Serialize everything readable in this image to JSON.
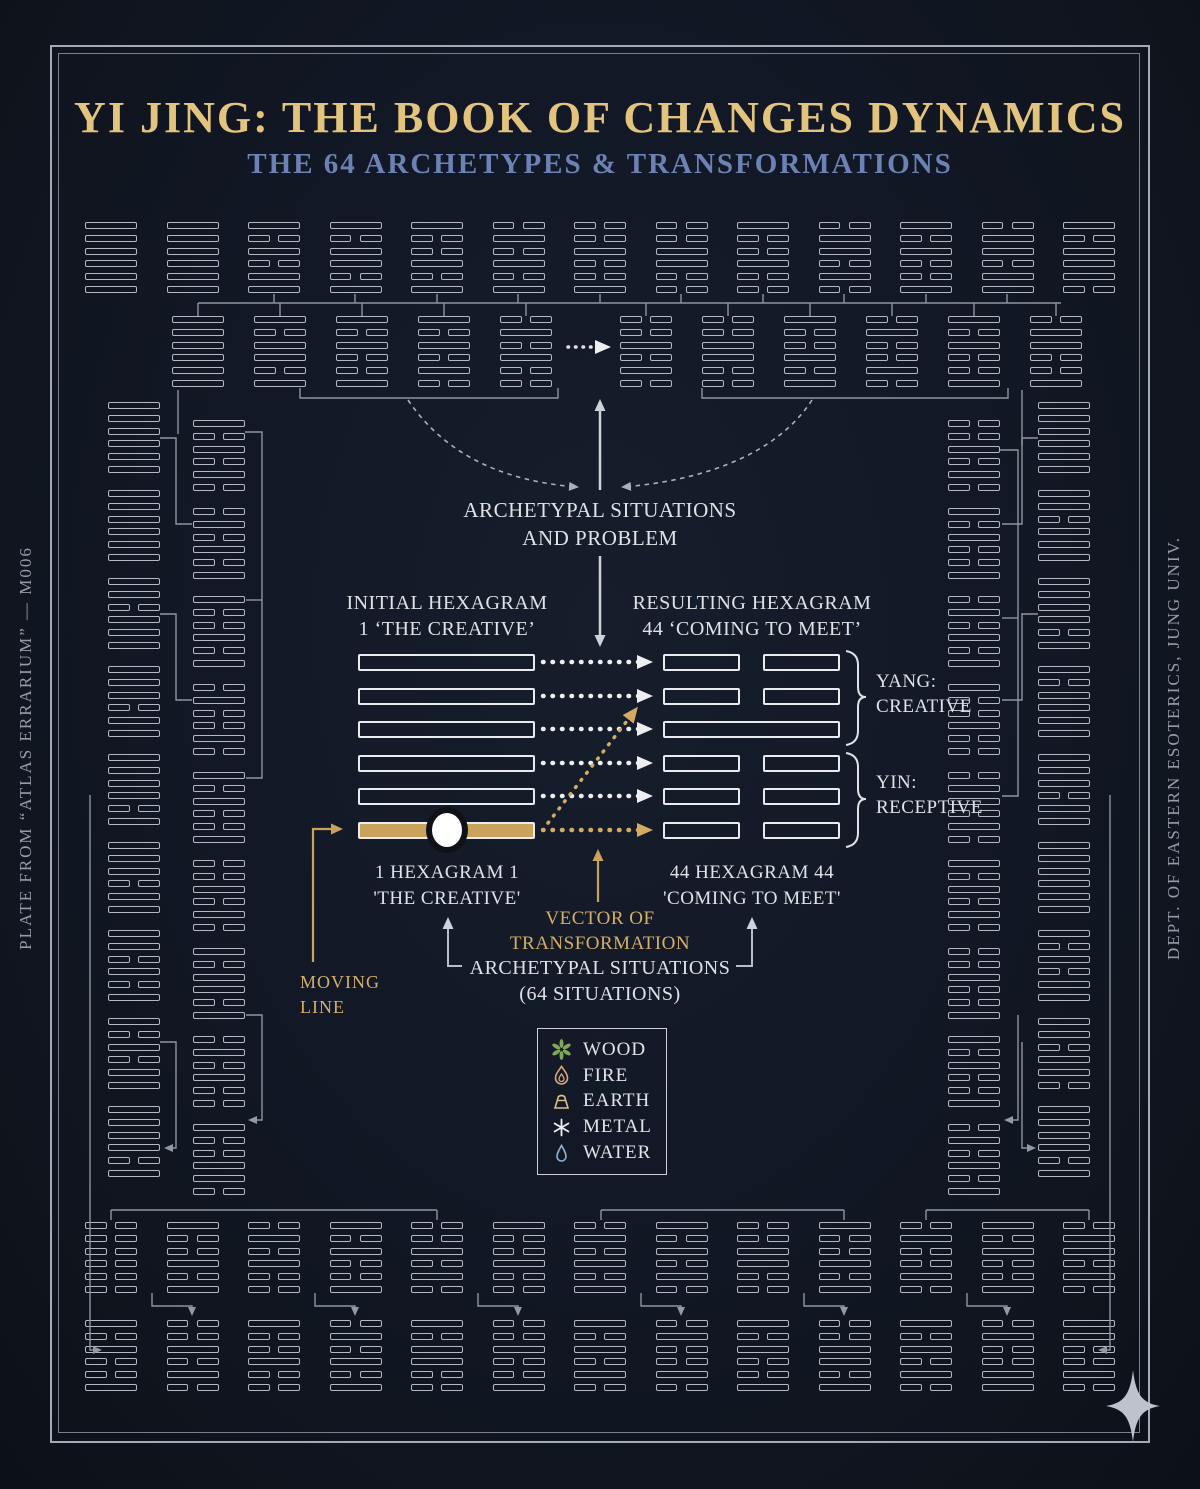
{
  "title": "YI JING: THE BOOK OF CHANGES DYNAMICS",
  "subtitle": "THE 64 ARCHETYPES & TRANSFORMATIONS",
  "side_left": "PLATE FROM “ATLAS ERRARIUM” — M006",
  "side_right": "DEPT. OF EASTERN ESOTERICS, JUNG UNIV.",
  "colors": {
    "background": "#121826",
    "title_gold": "#e3c47e",
    "subtitle_blue": "#6d82b4",
    "gold_accent": "#c9a35c",
    "gold_text": "#d4af69",
    "hexagram_line": "#c2c8d1",
    "text_white": "#dfe2e7"
  },
  "center": {
    "archetypal_top_line1": "ARCHETYPAL SITUATIONS",
    "archetypal_top_line2": "AND PROBLEM",
    "initial_label_line1": "INITIAL HEXAGRAM",
    "initial_label_line2": "1 ‘THE CREATIVE’",
    "resulting_label_line1": "RESULTING HEXAGRAM",
    "resulting_label_line2": "44 ‘COMING TO MEET’",
    "yang_label_line1": "YANG:",
    "yang_label_line2": "CREATIVE",
    "yin_label_line1": "YIN:",
    "yin_label_line2": "RECEPTIVE",
    "initial_caption_line1": "1 HEXAGRAM 1",
    "initial_caption_line2": "'THE CREATIVE'",
    "resulting_caption_line1": "44 HEXAGRAM 44",
    "resulting_caption_line2": "'COMING TO MEET'",
    "vector_label_line1": "VECTOR OF",
    "vector_label_line2": "TRANSFORMATION",
    "situations_label_line1": "ARCHETYPAL SITUATIONS",
    "situations_label_line2": "(64 SITUATIONS)",
    "moving_line_label_line1": "MOVING",
    "moving_line_label_line2": "LINE"
  },
  "legend": {
    "items": [
      {
        "name": "wood",
        "label": "WOOD",
        "color": "#7fa65b"
      },
      {
        "name": "fire",
        "label": "FIRE",
        "color": "#d9a877"
      },
      {
        "name": "earth",
        "label": "EARTH",
        "color": "#d9c08a"
      },
      {
        "name": "metal",
        "label": "METAL",
        "color": "#eef0f2"
      },
      {
        "name": "water",
        "label": "WATER",
        "color": "#8db4d6"
      }
    ]
  },
  "hexagram_field": {
    "groups": [
      {
        "name": "central-initial",
        "big": true,
        "x": 358,
        "y": 654,
        "dx": 0,
        "dy": 0,
        "w": 177,
        "lh": 17,
        "gap": 16.5,
        "patterns": [
          "SSSSSM"
        ]
      },
      {
        "name": "central-resulting",
        "big": true,
        "x": 663,
        "y": 654,
        "dx": 0,
        "dy": 0,
        "w": 177,
        "lh": 17,
        "gap": 16.5,
        "patterns": [
          "BBSBBB"
        ]
      },
      {
        "name": "top-row-1",
        "x": 85,
        "y": 222,
        "dx": 81.5,
        "dy": 0,
        "w": 52,
        "lh": 7,
        "gap": 5.8,
        "patterns": [
          "SSSSSS",
          "SSSSSS",
          "SBSBSS",
          "SBSSBS",
          "SBBSBS",
          "BSBSBS",
          "BBSBBS",
          "BBSSBB",
          "SBBSBB",
          "BSSBSB",
          "SBSBBS",
          "BSSBSS",
          "SBSSSB"
        ]
      },
      {
        "name": "top-row-2-left",
        "x": 172,
        "y": 316,
        "dx": 82,
        "dy": 0,
        "w": 52,
        "lh": 7,
        "gap": 5.8,
        "patterns": [
          "SSSSSS",
          "SBSSBS",
          "SBSBBS",
          "SBSBSB",
          "BSBSBB"
        ]
      },
      {
        "name": "top-row-2-right",
        "x": 620,
        "y": 316,
        "dx": 82,
        "dy": 0,
        "w": 52,
        "lh": 7,
        "gap": 5.8,
        "patterns": [
          "BBSBSB",
          "BBSSBB",
          "SBBSBS",
          "BSBBSB",
          "SBSBBS",
          "BSSBBS"
        ]
      },
      {
        "name": "left-col-outer",
        "x": 108,
        "y": 402,
        "dx": 0,
        "dy": 88,
        "w": 52,
        "lh": 7,
        "gap": 5.8,
        "patterns": [
          "SSSSSS",
          "SSSSSS",
          "SSBSSS",
          "SSSBSS",
          "SSSSBS",
          "SSSBSS",
          "SSBSBS",
          "SBSBSS",
          "SSSSBS"
        ]
      },
      {
        "name": "left-col-inner",
        "x": 193,
        "y": 420,
        "dx": 0,
        "dy": 88,
        "w": 52,
        "lh": 7,
        "gap": 5.8,
        "patterns": [
          "SBSBSB",
          "BSBSBS",
          "SBBSBS",
          "BSBBSB",
          "SBSBBS",
          "BBSBSB",
          "SBSSBS",
          "BSBSBB",
          "SBBSSB"
        ]
      },
      {
        "name": "right-col-inner",
        "x": 948,
        "y": 420,
        "dx": 0,
        "dy": 88,
        "w": 52,
        "lh": 7,
        "gap": 5.8,
        "patterns": [
          "BBSBSB",
          "SBSBBS",
          "BSBSBS",
          "SBBSBB",
          "BSSBSB",
          "SBSBSB",
          "BBSBBS",
          "SBSBBS",
          "BSBSBS"
        ]
      },
      {
        "name": "right-col-outer",
        "x": 1038,
        "y": 402,
        "dx": 0,
        "dy": 88,
        "w": 52,
        "lh": 7,
        "gap": 5.8,
        "patterns": [
          "SSSSSS",
          "SSBSSS",
          "SSSSBS",
          "SBSSSS",
          "SSSBSS",
          "SSSSSS",
          "SBSBSS",
          "SSBSSB",
          "SSSSBS"
        ]
      },
      {
        "name": "bottom-row-1",
        "x": 85,
        "y": 1222,
        "dx": 81.5,
        "dy": 0,
        "w": 52,
        "lh": 7,
        "gap": 5.8,
        "patterns": [
          "BBBBBB",
          "SBBSBS",
          "BSBSBB",
          "SBSBBS",
          "BBSBSB",
          "SBBSBB",
          "BSBSBS",
          "SBSBSB",
          "BBSSBB",
          "SBBSBS",
          "BSBBSB",
          "SBSBBS",
          "BSSBSB"
        ]
      },
      {
        "name": "bottom-row-2",
        "x": 85,
        "y": 1320,
        "dx": 81.5,
        "dy": 0,
        "w": 52,
        "lh": 7,
        "gap": 5.8,
        "patterns": [
          "SBSBBS",
          "BBSBSB",
          "SBBSBB",
          "BSBSBS",
          "SBSSBB",
          "BBSBBS",
          "SBSBSB",
          "BSBBSB",
          "SBSBBS",
          "BBSSBS",
          "SBSBSB",
          "BSBBSS",
          "SSBBSB"
        ]
      }
    ]
  }
}
